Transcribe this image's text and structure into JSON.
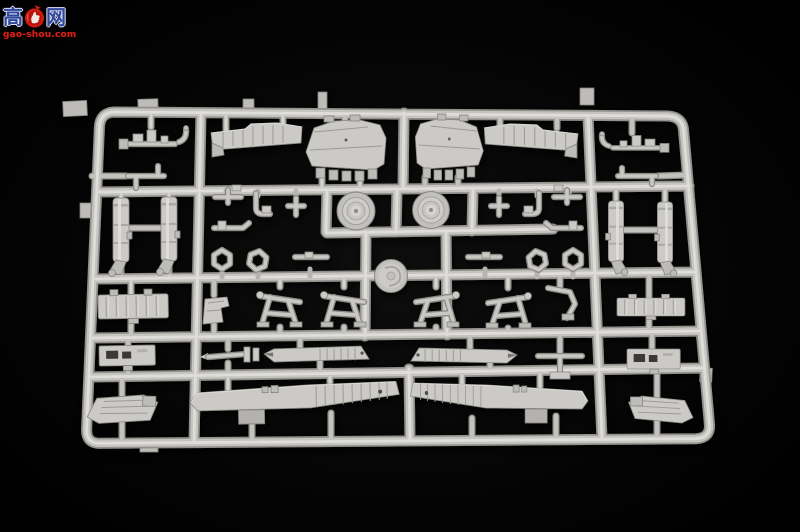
{
  "meta": {
    "description": "Product photo: one light-grey styrene injection-molded sprue (parts runner) of a plastic scale model kit, lying on a black background, photographed at a slight angle.",
    "subject": "model-kit-sprue"
  },
  "watermark": {
    "char_left": "高",
    "char_right": "网",
    "url": "gao-shou.com",
    "emblem": "red thumbs-up badge"
  },
  "colors": {
    "background": "#020202",
    "sprue": "#c5c4c0",
    "sprue_highlight": "#deddd9",
    "sprue_shadow": "#92918c",
    "watermark_blue": "#31479e",
    "watermark_red": "#da2016"
  },
  "sprue": {
    "material": "light grey styrene",
    "parts": [
      {
        "name": "cockpit-floor-panel",
        "count": 2
      },
      {
        "name": "cockpit-sidewall-strip",
        "count": 2
      },
      {
        "name": "actuator-assembly",
        "count": 2
      },
      {
        "name": "landing-gear-strut-cylinder",
        "count": 4
      },
      {
        "name": "main-wheel",
        "count": 2
      },
      {
        "name": "small-linkage",
        "count": 12
      },
      {
        "name": "ring-clamp",
        "count": 4
      },
      {
        "name": "ribbed-bulkhead",
        "count": 2
      },
      {
        "name": "crew-seat",
        "count": 1
      },
      {
        "name": "a-frame-brace",
        "count": 4
      },
      {
        "name": "bent-lever",
        "count": 1
      },
      {
        "name": "vented-panel",
        "count": 2
      },
      {
        "name": "tapered-flap-section",
        "count": 2
      },
      {
        "name": "gun-barrel-part",
        "count": 1
      },
      {
        "name": "t-bracket",
        "count": 1
      },
      {
        "name": "large-wing-panel",
        "count": 2
      },
      {
        "name": "corner-flap-panel",
        "count": 2
      },
      {
        "name": "center-mold-disc",
        "count": 1
      }
    ]
  }
}
